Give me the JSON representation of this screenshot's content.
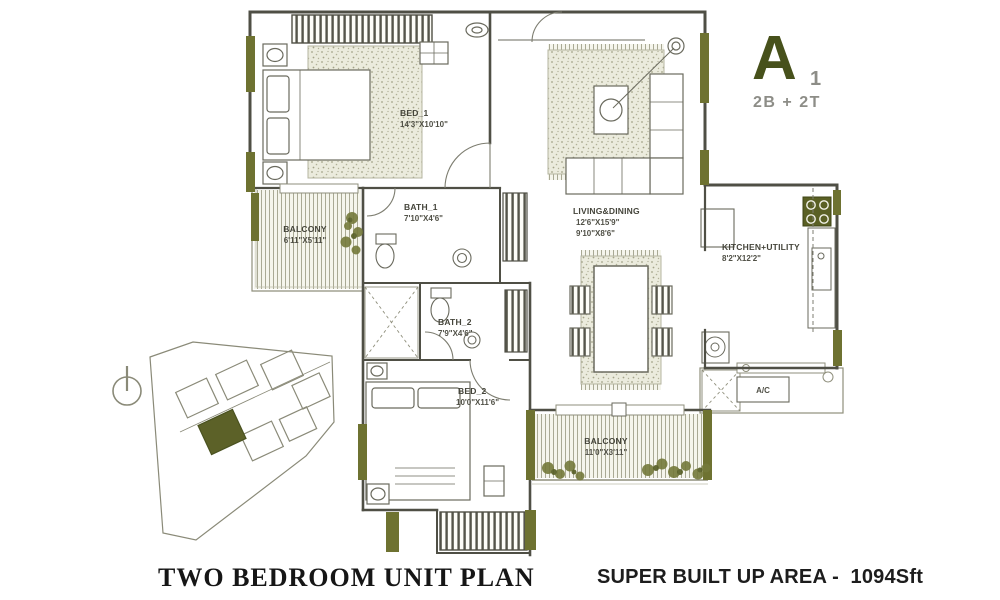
{
  "header": {
    "block_letter": "A",
    "unit_number": "1",
    "configuration": "2B + 2T"
  },
  "footer": {
    "plan_title": "TWO BEDROOM UNIT PLAN",
    "area_label": "SUPER BUILT UP AREA -  1094Sft"
  },
  "rooms": {
    "bed1": {
      "name": "BED_1",
      "dims": "14'3\"X10'10\""
    },
    "bath1": {
      "name": "BATH_1",
      "dims": "7'10\"X4'6\""
    },
    "balcony1": {
      "name": "BALCONY",
      "dims": "6'11\"X5'11\""
    },
    "living": {
      "name": "LIVING&DINING",
      "dims_living": "12'6\"X15'9\"",
      "dims_dining": "9'10\"X8'6\""
    },
    "kitchen": {
      "name": "KITCHEN+UTILITY",
      "dims": "8'2\"X12'2\""
    },
    "bath2": {
      "name": "BATH_2",
      "dims": "7'9\"X4'6\""
    },
    "bed2": {
      "name": "BED_2",
      "dims": "10'0\"X11'6\""
    },
    "balcony2": {
      "name": "BALCONY",
      "dims": "11'0\"X3'11\""
    },
    "ac_ledge": {
      "name": "A/C"
    }
  },
  "colors": {
    "olive_window": "#6e7231",
    "accent_dark": "#47511b",
    "wall": "#4f4f45",
    "muted_gray": "#8d8d87",
    "plant_green": "#5c6128"
  }
}
